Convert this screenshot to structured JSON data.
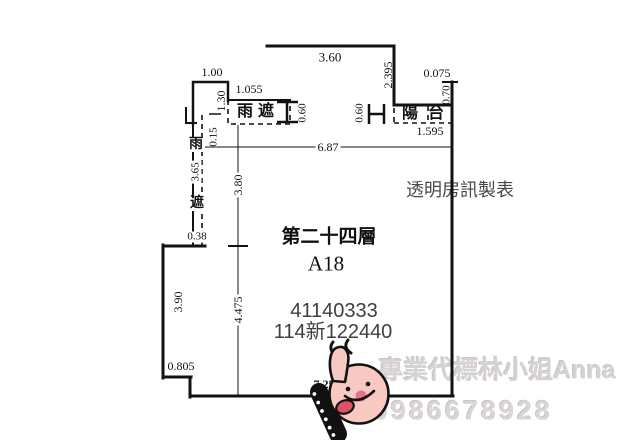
{
  "page": {
    "width": 640,
    "height": 444,
    "background": "#ffffff"
  },
  "colors": {
    "line": "#121212",
    "dim_text": "#111111",
    "serial_text": "#3f3f3f",
    "maker_text": "#4a4a4a",
    "watermark_text": "#d6d2d2",
    "sticker_pink": "#f8c8c3",
    "sticker_cheek": "#e4738b",
    "sticker_tongue": "#dd5168",
    "sticker_outline": "#111111"
  },
  "plan_info": {
    "floor": "第二十四層",
    "unit": "A18",
    "serial_1": "41140333",
    "serial_2": "114新122440"
  },
  "rooms": {
    "rain_shelter": "雨遮",
    "balcony": "陽台"
  },
  "watermarks": {
    "maker": "透明房訊製表",
    "agent": "專業代標林小姐Anna",
    "phone": "0986678928"
  },
  "dimensions": [
    "1.00",
    "3.60",
    "2.395",
    "0.075",
    "1.055",
    "1.30",
    "0.15",
    "0.60",
    "0.60",
    "0.70",
    "1.595",
    "6.87",
    "3.80",
    "3.65",
    "0.38",
    "4.475",
    "3.90",
    "0.805",
    "7.25"
  ],
  "labels": [
    {
      "name": "dim-1-00",
      "text": "1.00",
      "x": 212,
      "y": 72,
      "size": 12
    },
    {
      "name": "dim-3-60",
      "text": "3.60",
      "x": 330,
      "y": 57,
      "size": 13
    },
    {
      "name": "dim-2-395",
      "text": "2.395",
      "x": 388,
      "y": 75,
      "size": 12,
      "rot": true
    },
    {
      "name": "dim-1-055",
      "text": "1.055",
      "x": 249,
      "y": 89,
      "size": 12
    },
    {
      "name": "dim-1-30",
      "text": "1.30",
      "x": 221,
      "y": 101,
      "size": 12,
      "rot": true
    },
    {
      "name": "dim-0-15",
      "text": "0.15",
      "x": 214,
      "y": 137,
      "size": 11,
      "rot": true
    },
    {
      "name": "room-rain-shelter",
      "text": "雨遮",
      "x": 258,
      "y": 112,
      "size": 16,
      "bold": true,
      "ls": 5
    },
    {
      "name": "dim-0-60-left",
      "text": "0.60",
      "x": 303,
      "y": 113,
      "size": 11,
      "rot": true
    },
    {
      "name": "dim-0-60-right",
      "text": "0.60",
      "x": 360,
      "y": 113,
      "size": 11,
      "rot": true
    },
    {
      "name": "room-balcony",
      "text": "陽台",
      "x": 428,
      "y": 114,
      "size": 16,
      "bold": true,
      "ls": 10
    },
    {
      "name": "dim-0-075",
      "text": "0.075",
      "x": 437,
      "y": 73,
      "size": 12
    },
    {
      "name": "dim-0-70",
      "text": "0.70",
      "x": 447,
      "y": 95,
      "size": 11,
      "rot": true
    },
    {
      "name": "dim-1-595",
      "text": "1.595",
      "x": 430,
      "y": 131,
      "size": 12
    },
    {
      "name": "dim-6-87",
      "text": "6.87",
      "x": 328,
      "y": 147,
      "size": 12,
      "bgw": true
    },
    {
      "name": "dim-3-80",
      "text": "3.80",
      "x": 238,
      "y": 185,
      "size": 12,
      "rot": true,
      "bgw": true
    },
    {
      "name": "dim-4-475",
      "text": "4.475",
      "x": 238,
      "y": 310,
      "size": 12,
      "rot": true,
      "bgw": true
    },
    {
      "name": "room-rain-shelter-left-char1",
      "text": "雨",
      "x": 196,
      "y": 145,
      "size": 14,
      "bold": true,
      "bgw": true
    },
    {
      "name": "dim-3-65",
      "text": "3.65",
      "x": 196,
      "y": 172,
      "size": 11,
      "rot": true,
      "bgw": true
    },
    {
      "name": "room-rain-shelter-left-char2",
      "text": "遮",
      "x": 197,
      "y": 204,
      "size": 14,
      "bold": true,
      "bgw": true
    },
    {
      "name": "dim-0-38",
      "text": "0.38",
      "x": 197,
      "y": 237,
      "size": 11,
      "bgw": true
    },
    {
      "name": "dim-3-90",
      "text": "3.90",
      "x": 178,
      "y": 302,
      "size": 12,
      "rot": true
    },
    {
      "name": "dim-0-805",
      "text": "0.805",
      "x": 181,
      "y": 366,
      "size": 12
    },
    {
      "name": "dim-7-25",
      "text": "7.25",
      "x": 324,
      "y": 384,
      "size": 12,
      "bold": true
    },
    {
      "name": "floor-title",
      "text": "第二十四層",
      "x": 329,
      "y": 237,
      "size": 19,
      "bold": true
    },
    {
      "name": "unit-title",
      "text": "A18",
      "x": 326,
      "y": 264,
      "size": 21
    },
    {
      "name": "serial-number-1",
      "text": "41140333",
      "x": 334,
      "y": 311,
      "size": 20,
      "color": "#3f3f3f",
      "sans": true
    },
    {
      "name": "serial-number-2",
      "text": "114新122440",
      "x": 333,
      "y": 332,
      "size": 20,
      "color": "#3f3f3f",
      "sans": true
    },
    {
      "name": "maker-watermark",
      "text": "透明房訊製表",
      "x": 460,
      "y": 190,
      "size": 18,
      "color": "#4a4a4a",
      "layer": "back"
    },
    {
      "name": "agent-watermark",
      "text": "專業代標林小姐Anna",
      "x": 497,
      "y": 371,
      "size": 25,
      "color": "#d6d2d2",
      "bold": true,
      "layer": "back",
      "emboss": true,
      "sans": true
    },
    {
      "name": "phone-watermark",
      "text": "0986678928",
      "x": 463,
      "y": 411,
      "size": 27,
      "color": "#d9d5d5",
      "bold": true,
      "layer": "back",
      "emboss": true,
      "sans": true,
      "ls": 3
    }
  ]
}
